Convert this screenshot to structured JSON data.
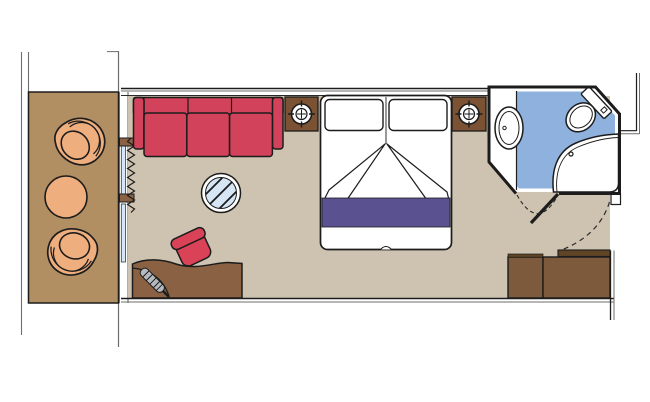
{
  "meta": {
    "title": "Balcony stateroom floor plan",
    "canvas": {
      "width": 650,
      "height": 402
    },
    "text_content": "none — drawing only, no visible text in image"
  },
  "colors": {
    "outline": "#1c1c1c",
    "structure_line": "#6e6e6e",
    "wall_white": "#ffffff",
    "balcony_floor": "#b28e63",
    "balcony_furniture": "#efae7d",
    "cabin_floor": "#cdc3b0",
    "sofa_red": "#d2425a",
    "stool_red": "#da4257",
    "desk_brown": "#8a6142",
    "nightstand_brown": "#7b5233",
    "wardrobe_brown": "#7d5a3b",
    "door_leaf_brown": "#5f4526",
    "bed_runner_purple": "#5a5190",
    "bathroom_floor_blue": "#8fb1de",
    "glass_blue": "#d7e6f5",
    "appliance_grey": "#b4bac0"
  },
  "areas": {
    "balcony": "private balcony with two tub chairs and round table",
    "cabin": "main cabin with sofa, glass table, desk, stool, double bed, two nightstands",
    "bathroom": "bathroom with washbasin, toilet and shower",
    "entry": "entrance with door swing arc and wardrobe"
  },
  "furniture_icons": [
    "tub-chair-icon",
    "round-table-icon",
    "curtain-zigzag-icon",
    "sliding-glass-door-icon",
    "sofa-icon",
    "glass-table-icon",
    "desk-icon",
    "hairdryer-icon",
    "stool-icon",
    "nightstand-icon",
    "lamp-crosshair-icon",
    "double-bed-icon",
    "pillow-icon",
    "duvet-fold-icon",
    "bed-runner-icon",
    "washbasin-icon",
    "toilet-icon",
    "shower-icon",
    "door-leaf-icon",
    "door-swing-dashed-icon",
    "wardrobe-icon"
  ]
}
